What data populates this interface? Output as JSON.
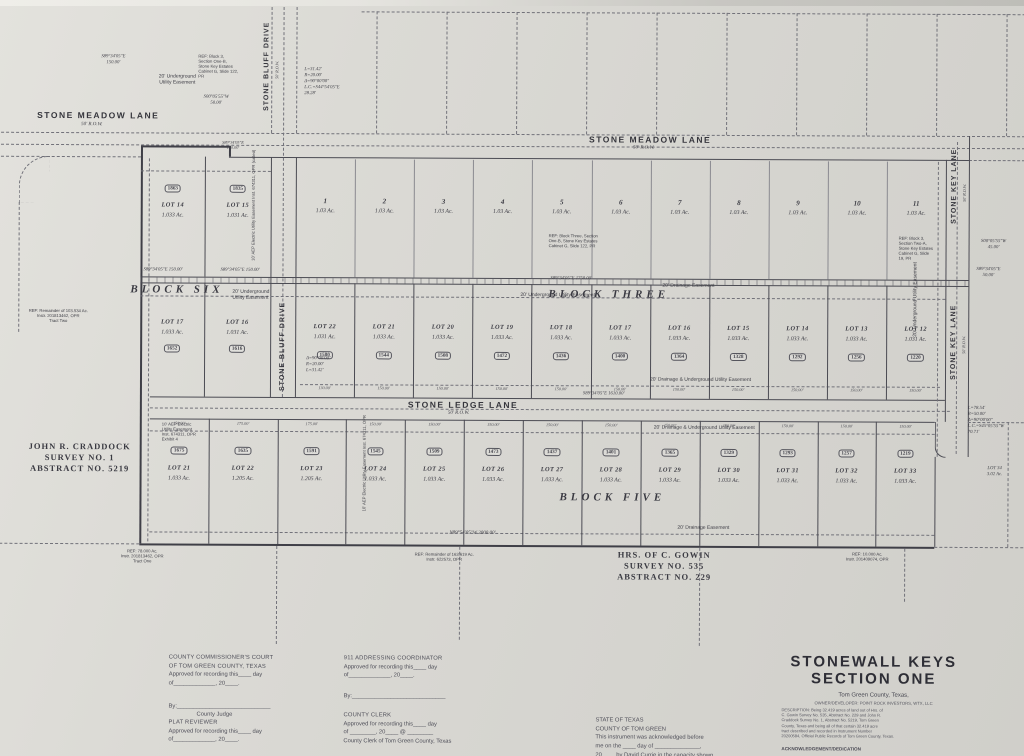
{
  "labels": {
    "street_meadow_left": "STONE MEADOW LANE",
    "street_meadow_left_row": "50' R.O.W.",
    "street_meadow_mid": "STONE MEADOW LANE",
    "street_meadow_mid_row": "50' R.O.W.",
    "street_bluff_top": "STONE BLUFF DRIVE",
    "street_bluff_top_row": "50' R.O.W.",
    "street_bluff_mid": "STONE BLUFF DRIVE",
    "street_ledge": "STONE LEDGE LANE",
    "street_ledge_row": "50' R.O.W.",
    "street_key_top": "STONE KEY LANE",
    "street_key_top_row": "50' R.O.W.",
    "street_key_mid": "STONE KEY LANE",
    "street_key_mid_row": "50' R.O.W.",
    "block_six": "BLOCK SIX",
    "block_three": "BLOCK THREE",
    "block_five": "BLOCK FIVE",
    "survey_craddock": "JOHN R. CRADDOCK\nSURVEY NO. 1\nABSTRACT NO. 5219",
    "survey_gowin": "HRS. OF C. GOWIN\nSURVEY NO. 535\nABSTRACT NO. 229",
    "bearing_tl": "S89°34'05\"E\n150.00'",
    "bearing_tl2": "S00°05'55\"W\n50.00'",
    "bearing_north_150a": "S89°34'05\"E  150.00'",
    "bearing_north_150b": "S89°34'05\"E  150.00'",
    "bearing_mid130": "S89°34'05\"E\n130.00'",
    "bearing_row_c_top": "S89°34'05\"E   1750.00'",
    "bearing_ledge": "S89°34'05\"E   1610.00'",
    "bearing_south": "N89°54'05\"W   2000.00'",
    "bearing_key1": "S00°05'55\"W\n45.00'",
    "bearing_key2": "S89°34'05\"E\n50.00'",
    "curve_top": "L=31.42'\nR=20.00'\nΔ=90°00'00\"\nL.C.=S44°54'05\"E\n28.28'",
    "curve_mid": "Δ=90°00'00\"\nR=20.00'\nL=31.42'",
    "curve_right": "L=78.54'\nR=50.00'\nΔ=90°00'00\"\nL.C.=S45°05'55\"W\n70.71'",
    "esmt_util_b6_top": "20' Underground\nUtility Easement",
    "esmt_util_b6": "20' Underground\nUtility Easement",
    "esmt_util_b3": "20' Underground Utility Easement",
    "esmt_drain_b3": "20' Drainage Easement",
    "esmt_du_above": "20' Drainage & Underground Utility Easement",
    "esmt_du_below": "20' Drainage & Underground Utility Easement",
    "esmt_drain_b5": "20' Drainage Easement",
    "esmt_util_key": "20' Underground\nUtility Easement",
    "esmt_aep_b6": "10' AEP Electric Utility Easement\nInst. 674311, OPR (called)",
    "esmt_aep_b5": "10' AEP Electric\nUtility Easement\nInst. 674311, OPR",
    "esmt_aep_b5b": "10' AEP Electric\nUtility Easement\nInst. 674311, OPR\nExhibit 4",
    "ref_tl": "REF: Block 3,\nSection One-B,\nStone Key Estates\nCabinet G, Slide 122,\nPR",
    "ref_rowa_left": "REF: Block Three, Section\nOne-B, Stone Key Estates\nCabinet G, Slide 122, PR",
    "ref_rowa_right": "REF: Block 3,\nSection Two-A,\nStone Key Estates\nCabinet G, Slide\n19, PR",
    "ref_west": "REF: Remainder of 103.534 Ac.\nInstr. 201813462, OPR\nTract Two",
    "ref_sw": "REF: 78.000 Ac.\nInstr. 201813462, OPR\nTract One",
    "ref_s": "REF: Remainder of 163.619 Ac.\nInstr. 622573, OPR",
    "ref_se": "REF: 10.000 Ac.\nInstr. 201409074, OPR",
    "partial_lot": "LOT 34\n3.02 Ac."
  },
  "lots": {
    "row_a": {
      "nums": [
        "1",
        "2",
        "3",
        "4",
        "5",
        "6",
        "7",
        "8",
        "9",
        "10",
        "11"
      ],
      "ac": "1.03 Ac."
    },
    "row_b": [
      {
        "name": "LOT 14",
        "ac": "1.033 Ac.",
        "badge": "1863"
      },
      {
        "name": "LOT 15",
        "ac": "1.031 Ac.",
        "badge": "1835"
      }
    ],
    "row_c_left": [
      {
        "name": "LOT 17",
        "ac": "1.033 Ac.",
        "badge": "1652"
      },
      {
        "name": "LOT 16",
        "ac": "1.031 Ac.",
        "badge": "1616"
      }
    ],
    "row_c": [
      {
        "name": "LOT 22",
        "ac": "1.031 Ac.",
        "badge": "1580"
      },
      {
        "name": "LOT 21",
        "ac": "1.033 Ac.",
        "badge": "1544"
      },
      {
        "name": "LOT 20",
        "ac": "1.033 Ac.",
        "badge": "1508"
      },
      {
        "name": "LOT 19",
        "ac": "1.033 Ac.",
        "badge": "1472"
      },
      {
        "name": "LOT 18",
        "ac": "1.033 Ac.",
        "badge": "1436"
      },
      {
        "name": "LOT 17",
        "ac": "1.033 Ac.",
        "badge": "1400"
      },
      {
        "name": "LOT 16",
        "ac": "1.033 Ac.",
        "badge": "1364"
      },
      {
        "name": "LOT 15",
        "ac": "1.033 Ac.",
        "badge": "1328"
      },
      {
        "name": "LOT 14",
        "ac": "1.033 Ac.",
        "badge": "1292"
      },
      {
        "name": "LOT 13",
        "ac": "1.033 Ac.",
        "badge": "1256"
      },
      {
        "name": "LOT 12",
        "ac": "1.031 Ac.",
        "badge": "1220"
      }
    ],
    "row_d": [
      {
        "name": "LOT 21",
        "ac": "1.033 Ac.",
        "badge": "1675",
        "wide": false
      },
      {
        "name": "LOT 22",
        "ac": "1.205 Ac.",
        "badge": "1635",
        "wide": true
      },
      {
        "name": "LOT 23",
        "ac": "1.205 Ac.",
        "badge": "1591",
        "wide": true
      },
      {
        "name": "LOT 24",
        "ac": "1.033 Ac.",
        "badge": "1545",
        "wide": false
      },
      {
        "name": "LOT 25",
        "ac": "1.033 Ac.",
        "badge": "1509",
        "wide": false
      },
      {
        "name": "LOT 26",
        "ac": "1.033 Ac.",
        "badge": "1473",
        "wide": false
      },
      {
        "name": "LOT 27",
        "ac": "1.033 Ac.",
        "badge": "1437",
        "wide": false
      },
      {
        "name": "LOT 28",
        "ac": "1.033 Ac.",
        "badge": "1401",
        "wide": false
      },
      {
        "name": "LOT 29",
        "ac": "1.033 Ac.",
        "badge": "1365",
        "wide": false
      },
      {
        "name": "LOT 30",
        "ac": "1.033 Ac.",
        "badge": "1329",
        "wide": false
      },
      {
        "name": "LOT 31",
        "ac": "1.033 Ac.",
        "badge": "1293",
        "wide": false
      },
      {
        "name": "LOT 32",
        "ac": "1.033 Ac.",
        "badge": "1257",
        "wide": false
      },
      {
        "name": "LOT 33",
        "ac": "1.033 Ac.",
        "badge": "1219",
        "wide": false
      }
    ],
    "dims": {
      "std": "150.00'",
      "wide": "175.00'",
      "first": "130.00'"
    }
  },
  "forms": {
    "commissioners": {
      "heading1": "COUNTY COMMISSIONER'S COURT",
      "heading2": "OF TOM GREEN COUNTY, TEXAS",
      "line1": "Approved for recording this____ day",
      "line2": "of_____________, 20____.",
      "by_line": "By:_____________________________",
      "by_role": "County Judge"
    },
    "addressing": {
      "heading": "911 ADDRESSING COORDINATOR",
      "line1": "Approved for recording this____ day",
      "line2": "of_____________, 20____.",
      "by_line": "By:_____________________________"
    },
    "plat_reviewer": {
      "heading": "PLAT REVIEWER",
      "line1": "Approved for recording this____ day",
      "line2": "of_____________, 20____."
    },
    "county_clerk": {
      "heading": "COUNTY CLERK",
      "line1": "Approved for recording this____ day",
      "line2": "of ________, 20____ @ ________",
      "line3": "County Clerk of Tom Green County, Texas"
    },
    "notary": {
      "line1": "STATE OF TEXAS",
      "line2": "COUNTY OF TOM GREEN",
      "line3": "This instrument was acknowledged before",
      "line4": "me on the ____ day of ______________,",
      "line5": "20____ by David Currie in the capacity shown."
    }
  },
  "title_block": {
    "title_line1": "STONEWALL  KEYS",
    "title_line2": "SECTION ONE",
    "subtitle": "Tom Green County, Texas,",
    "owner": "OWNER/DEVELOPER: POINT ROCK INVESTORS, WTX, LLC",
    "description": "DESCRIPTION: Being 32.419 acres of land out of Hrs. of\nC. Gowin Survey No. 535, Abstract No. 229 and John R.\nCraddock Survey No. 1, Abstract No. 5219, Tom Green\nCounty, Texas and being all of that certain 32.419 acre\ntract described and recorded in Instrument Number\n20200584, Official Public Records of Tom Green County, Texas.",
    "ack_heading": "ACKNOWLEDGEMENT/DEDICATION"
  }
}
